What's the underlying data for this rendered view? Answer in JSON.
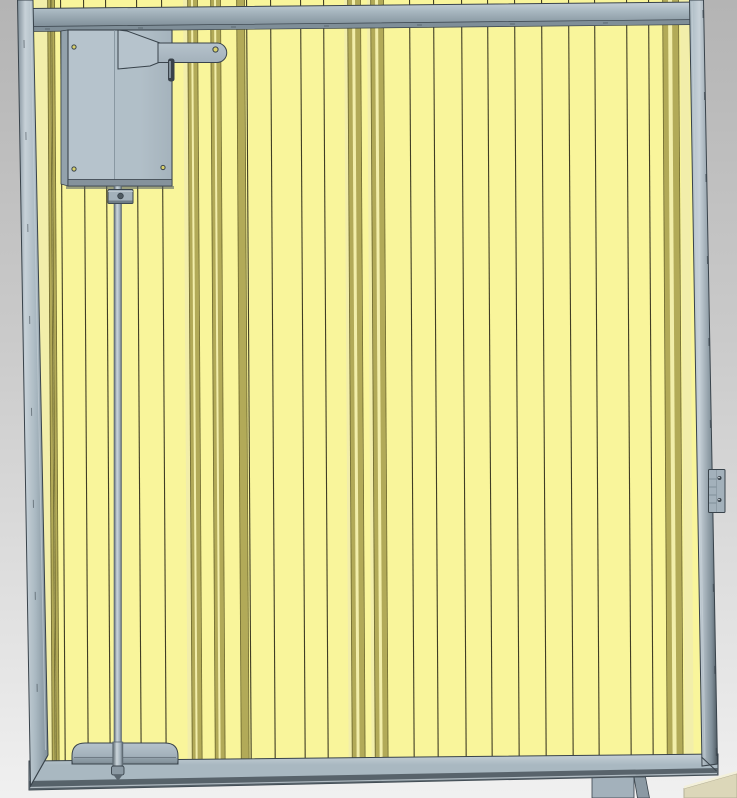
{
  "scene": {
    "kind": "3d-cad-render",
    "subject": "slatted gate panel assembly",
    "components": [
      "gate-frame-top-rail",
      "gate-frame-bottom-rail",
      "gate-frame-left-post",
      "gate-frame-right-post",
      "yellow-slat-panel",
      "lock-actuator-box",
      "actuator-arm",
      "vertical-drive-rod",
      "rod-guide-collar",
      "bottom-rod-bracket",
      "hinge-latch-plate",
      "support-leg",
      "floor-wedge-object"
    ]
  },
  "colors": {
    "bg_top": "#b4b4b4",
    "bg_mid": "#cacaca",
    "bg_bottom": "#f0f0f0",
    "line": "#39434b",
    "frame_light": "#c7d1d8",
    "frame_mid": "#a9b8c1",
    "frame_dark": "#7f8e98",
    "frame_deep": "#4f5a62",
    "panel_base": "#f9f59b",
    "slat_line": "#403d24",
    "olive": "#b2aa58",
    "olive_edge": "#6f692f",
    "light_band": "#f2eeaa",
    "box_face": "#b6c3cc",
    "box_side": "#93a2ac",
    "box_strip": "#85929c",
    "metal_mid": "#a3b1bb",
    "metal_dark": "#8b99a3",
    "rod_edge": "#5a666f",
    "rod_light": "#ccd6dc",
    "screw": "#d9d16b",
    "pin": "#39424a",
    "glint": "#e3e9ed",
    "wedge": "#dcd7b9",
    "wedge_light": "#f3f0da",
    "wedge_edge": "#b5b096"
  },
  "panel": {
    "skew_deg": 0.35,
    "dark_lines": [
      60,
      83,
      105,
      136,
      161,
      246,
      270,
      300,
      323,
      409,
      433,
      461,
      487,
      514,
      541,
      568,
      594,
      626,
      648
    ],
    "olive_bands": [
      {
        "x": 48,
        "w": 2
      },
      {
        "x": 52,
        "w": 2
      },
      {
        "x": 188,
        "w": 9
      },
      {
        "x": 211,
        "w": 9
      },
      {
        "x": 237,
        "w": 7
      },
      {
        "x": 348,
        "w": 12
      },
      {
        "x": 371,
        "w": 12
      },
      {
        "x": 663,
        "w": 15
      }
    ],
    "light_bands": [
      {
        "x": 35,
        "w": 13
      },
      {
        "x": 183,
        "w": 5
      },
      {
        "x": 344,
        "w": 4
      },
      {
        "x": 367,
        "w": 4
      },
      {
        "x": 680,
        "w": 9
      }
    ],
    "light_cores": [
      {
        "x": 191,
        "w": 2
      },
      {
        "x": 214,
        "w": 2
      },
      {
        "x": 352,
        "w": 3
      },
      {
        "x": 375,
        "w": 3
      },
      {
        "x": 668,
        "w": 4
      }
    ]
  }
}
